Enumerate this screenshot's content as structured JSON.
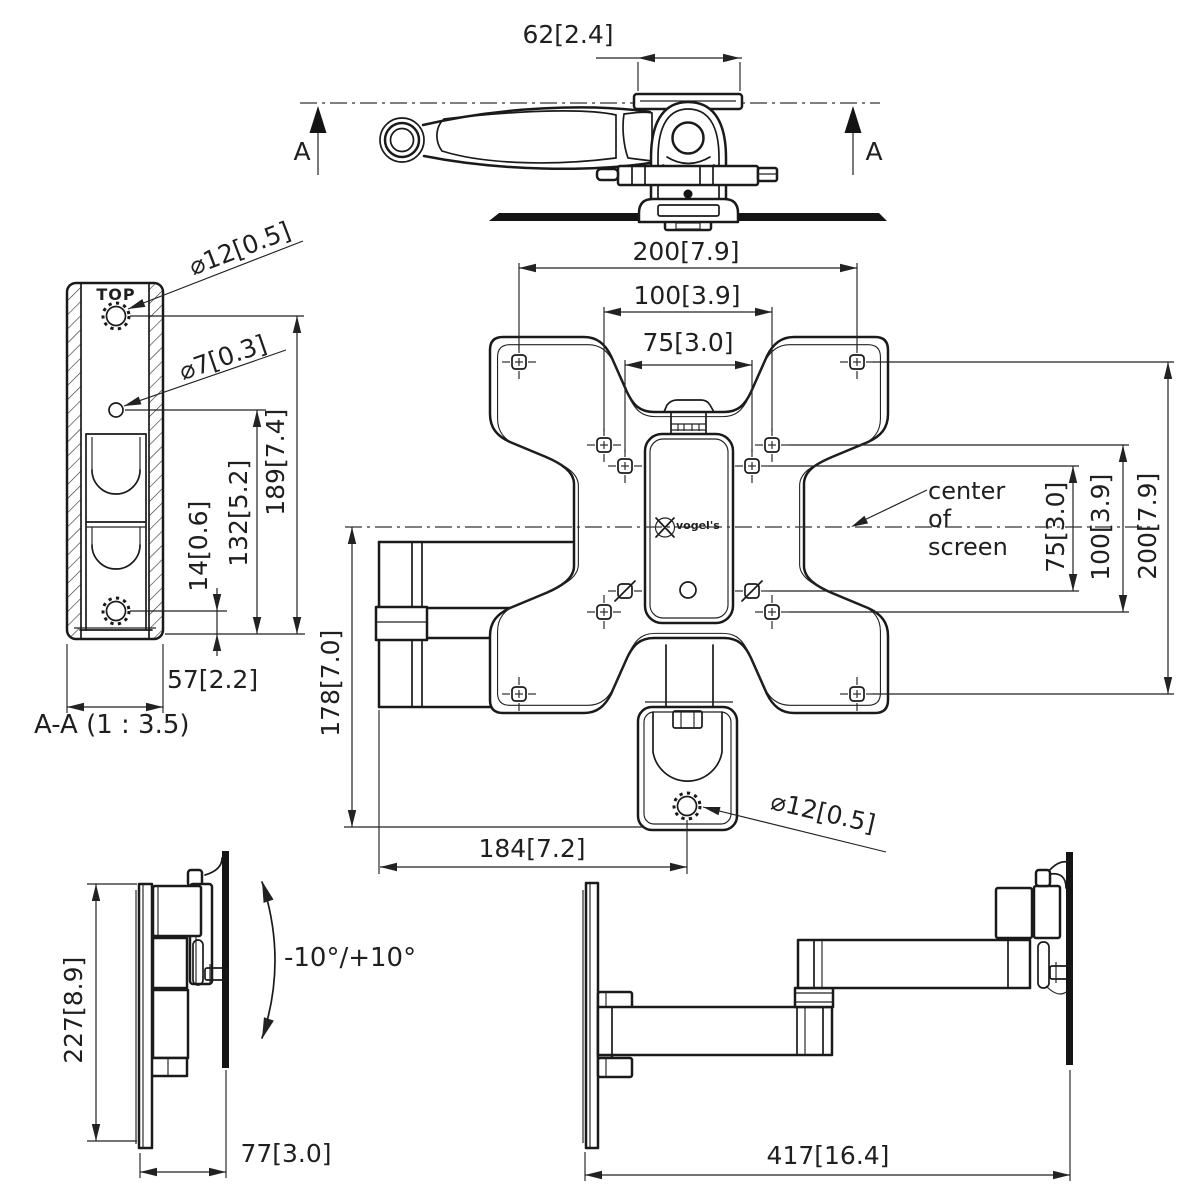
{
  "colors": {
    "background": "#ffffff",
    "line": "#1a1a1a"
  },
  "views": {
    "top_view": {
      "dim_offset": "62[2.4]",
      "section_letter": "A"
    },
    "section_view": {
      "label": "A-A (1 : 3.5)",
      "top_marker": "TOP",
      "dia_gear_hole": "⌀12[0.5]",
      "dia_small_hole": "⌀7[0.3]",
      "dim_gear_to_bottom": "189[7.4]",
      "dim_hole_to_bottom": "132[5.2]",
      "dim_lower_gear_to_bottom": "14[0.6]",
      "dim_width": "57[2.2]"
    },
    "front_view": {
      "dim_vesa_200_width": "200[7.9]",
      "dim_vesa_100_width": "100[3.9]",
      "dim_vesa_75_width": "75[3.0]",
      "dim_vesa_75_height": "75[3.0]",
      "dim_vesa_100_height": "100[3.9]",
      "dim_vesa_200_height": "200[7.9]",
      "dim_center_to_pivot": "178[7.0]",
      "dim_wall_to_pivot": "184[7.2]",
      "dia_pivot_hole": "⌀12[0.5]",
      "center_note": "center\nof\nscreen",
      "brand": "vogel's"
    },
    "folded_side_view": {
      "dim_height": "227[8.9]",
      "dim_depth": "77[3.0]",
      "tilt_range": "-10°/+10°"
    },
    "extended_side_view": {
      "dim_reach": "417[16.4]"
    }
  }
}
